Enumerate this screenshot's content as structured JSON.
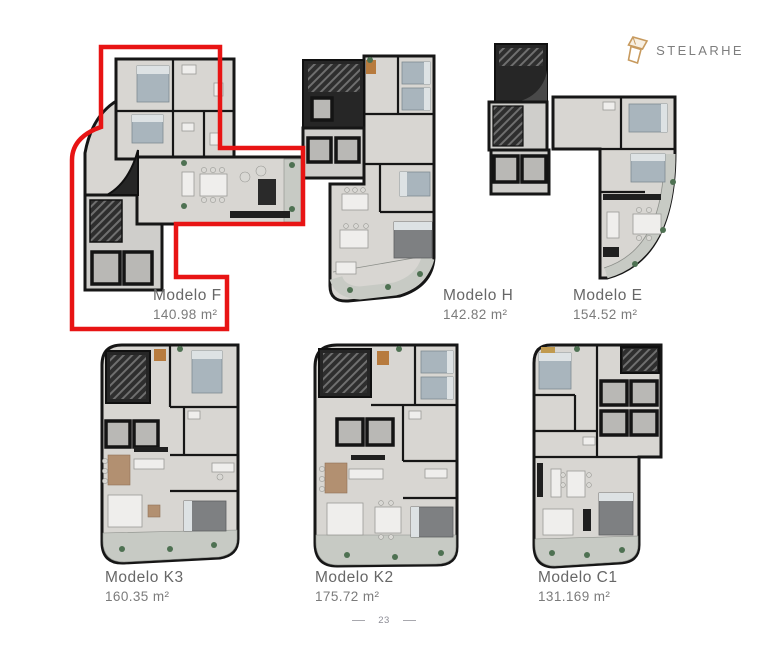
{
  "logo": {
    "brand": "STELARHE",
    "icon": "stelarhe-mark",
    "accent_color": "#c79a5e"
  },
  "models": [
    {
      "name": "Modelo F",
      "area": "140.98 m²",
      "highlighted": true,
      "highlight_color": "#e81414"
    },
    {
      "name": "Modelo H",
      "area": "142.82 m²",
      "highlighted": false
    },
    {
      "name": "Modelo E",
      "area": "154.52 m²",
      "highlighted": false
    },
    {
      "name": "Modelo K3",
      "area": "160.35 m²",
      "highlighted": false
    },
    {
      "name": "Modelo K2",
      "area": "175.72 m²",
      "highlighted": false
    },
    {
      "name": "Modelo C1",
      "area": "131.169 m²",
      "highlighted": false
    }
  ],
  "footer": {
    "page_number": "23"
  }
}
